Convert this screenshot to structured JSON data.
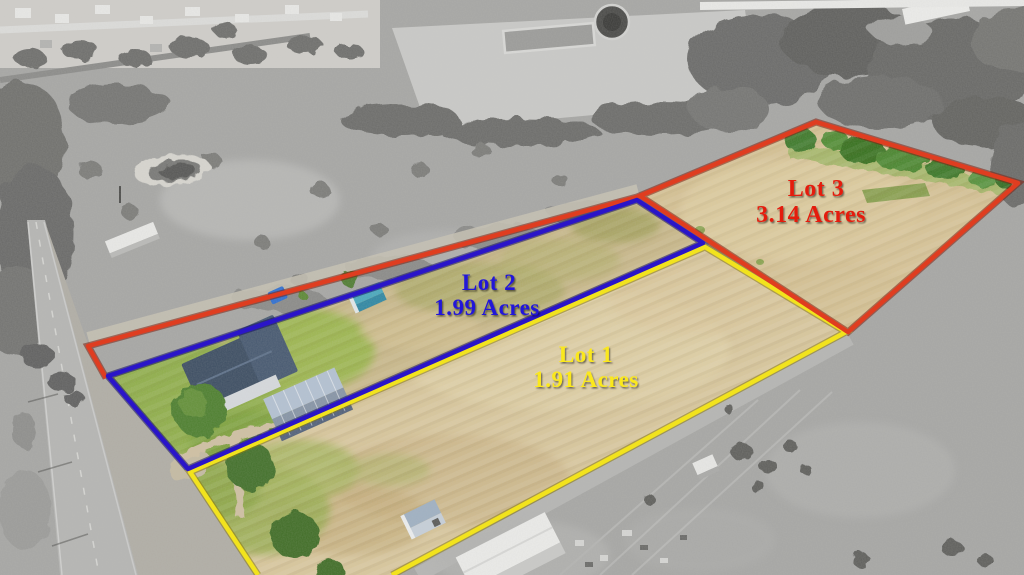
{
  "lots": [
    {
      "id": "lot-1",
      "label": "Lot 1",
      "acreage": "1.91 Acres",
      "outline_color": "#f2e31d",
      "label_color": "#fbe81e"
    },
    {
      "id": "lot-2",
      "label": "Lot 2",
      "acreage": "1.99 Acres",
      "outline_color": "#2a15c8",
      "label_color": "#2114d8"
    },
    {
      "id": "lot-3",
      "label": "Lot 3",
      "acreage": "3.14 Acres",
      "outline_color": "#df3d20",
      "label_color": "#e41d11"
    }
  ],
  "scene": {
    "field_color": "#d5c193",
    "lawn_color": "#8fae48",
    "surround_treatment_color": "#a4a4a2"
  }
}
